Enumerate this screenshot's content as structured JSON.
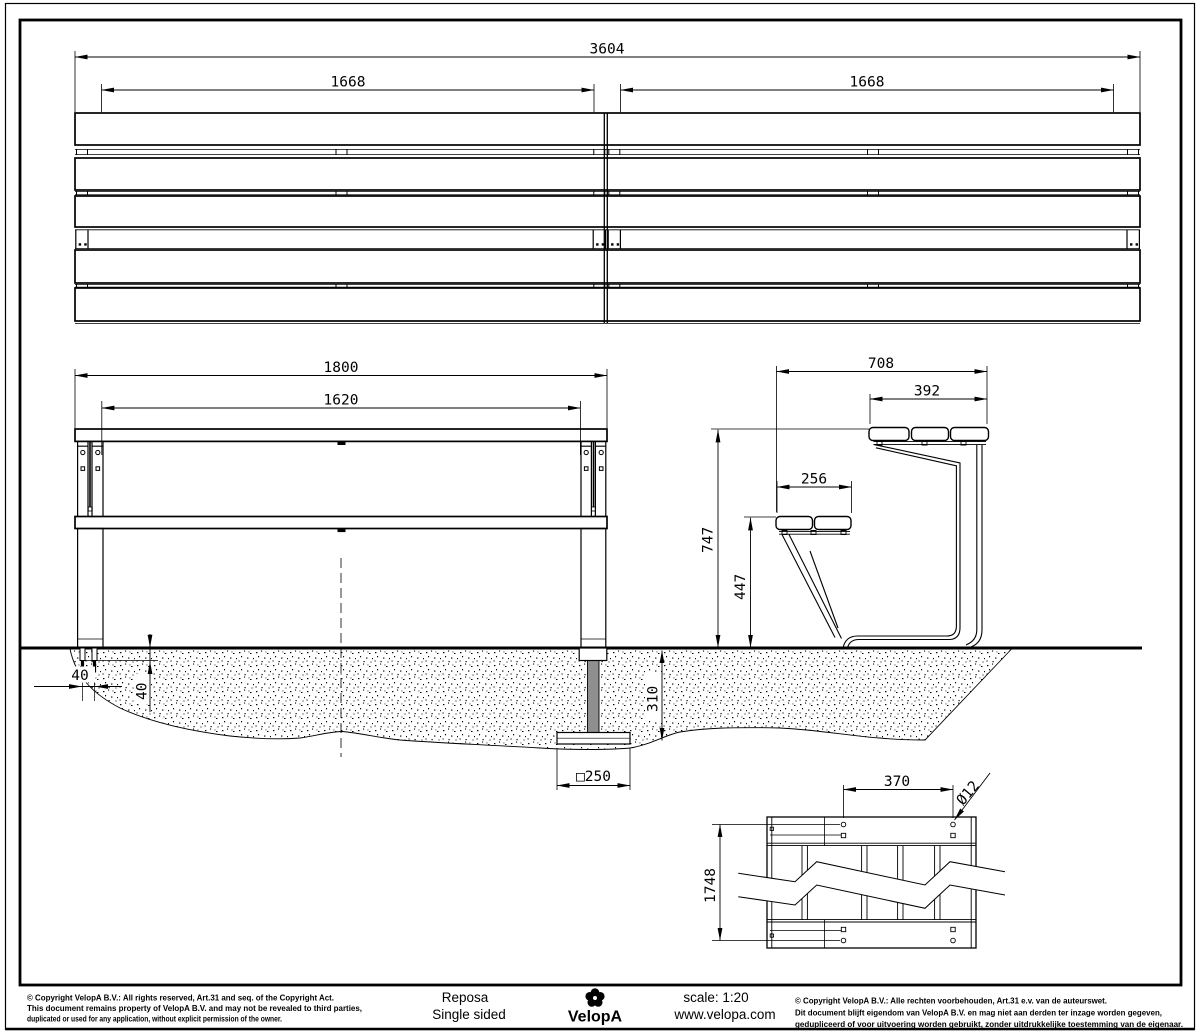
{
  "document": {
    "type": "technical-drawing",
    "product": "Reposa",
    "variant": "Single sided",
    "brand": "VelopA",
    "scale_label": "scale: 1:20",
    "website": "www.velopa.com"
  },
  "title_block": {
    "copyright_en": [
      "© Copyright VelopA B.V.: All rights reserved, Art.31 and seq. of the Copyright Act.",
      "This document remains property of VelopA B.V. and may not be revealed to third parties,",
      "duplicated or used for any application, without explicit permission of the owner."
    ],
    "copyright_nl": [
      "© Copyright VelopA B.V.: Alle rechten voorbehouden, Art.31 e.v. van de auteurswet.",
      "Dit document blijft eigendom van VelopA B.V. en mag niet aan derden ter inzage worden gegeven,",
      "gedupliceerd of voor uitvoering worden gebruikt, zonder uitdrukkelijke toestemming van de eigenaar."
    ]
  },
  "dimensions": {
    "top_view": {
      "overall_length": "3604",
      "left_module_span": "1668",
      "right_module_span": "1668"
    },
    "front_view": {
      "overall_width": "1800",
      "leg_spacing": "1620",
      "anchor_offset": "40",
      "anchor_depth": "40",
      "foundation_depth": "310",
      "foundation_plate": "□250"
    },
    "side_view": {
      "overall_depth": "708",
      "backrest_depth": "392",
      "seat_depth": "256",
      "backrest_height": "747",
      "seat_height": "447"
    },
    "bottom_view": {
      "hole_spacing": "370",
      "hole_diameter": "Ø12",
      "bearer_length": "1748"
    }
  },
  "colors": {
    "line": "#000000",
    "background": "#ffffff",
    "buried_post_fill": "#8f8f8f"
  }
}
